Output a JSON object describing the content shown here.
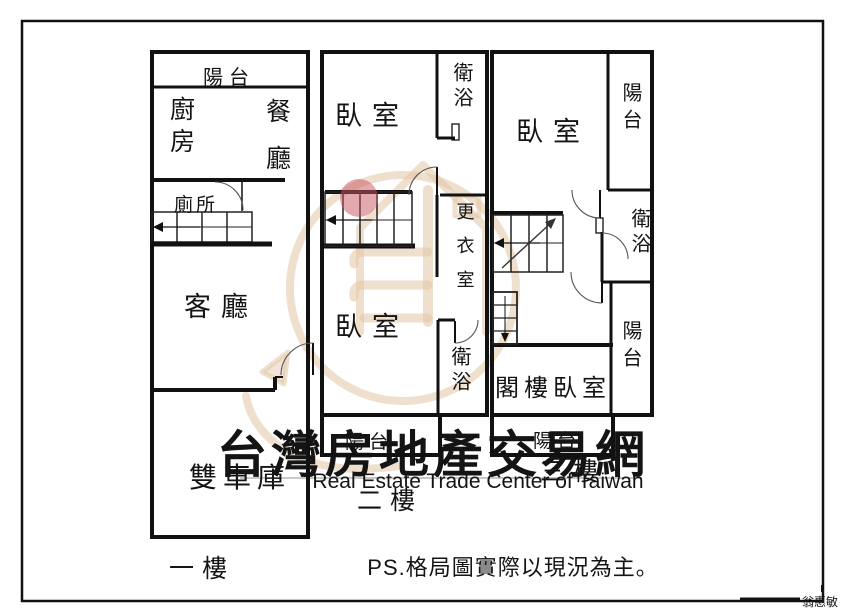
{
  "colors": {
    "wall_black": "#111111",
    "marker_pink": "#c5545e",
    "note_red": "#e12222",
    "watermark_gray": "#c8c8c8",
    "watermark_tan": "#e2c4a4"
  },
  "floor1": {
    "floor_label": "一樓",
    "balcony": "陽台",
    "kitchen": "廚房",
    "dining": "餐廳",
    "toilet": "廁所",
    "living": "客廳",
    "garage": "雙車庫"
  },
  "floor2": {
    "floor_label": "二樓",
    "bedroom_top": "臥室",
    "bath_top": "衛浴",
    "closet": "更衣室",
    "bedroom_bottom": "臥室",
    "bath_bottom": "衛浴",
    "balcony": "陽台"
  },
  "floor3": {
    "floor_label": "三樓",
    "bedroom": "臥室",
    "balcony_top": "陽台",
    "bath": "衛浴",
    "balcony_mid": "陽台",
    "attic_bedroom": "閣樓臥室",
    "balcony_bottom": "陽台"
  },
  "watermark": {
    "title_cn": "台灣房地產交易網",
    "subtitle_en": "Real Estate Trade Center of Taiwan"
  },
  "note": {
    "text": "PS.格局圖實際以現況為主。"
  },
  "signature": {
    "name": "翁惠敏"
  }
}
